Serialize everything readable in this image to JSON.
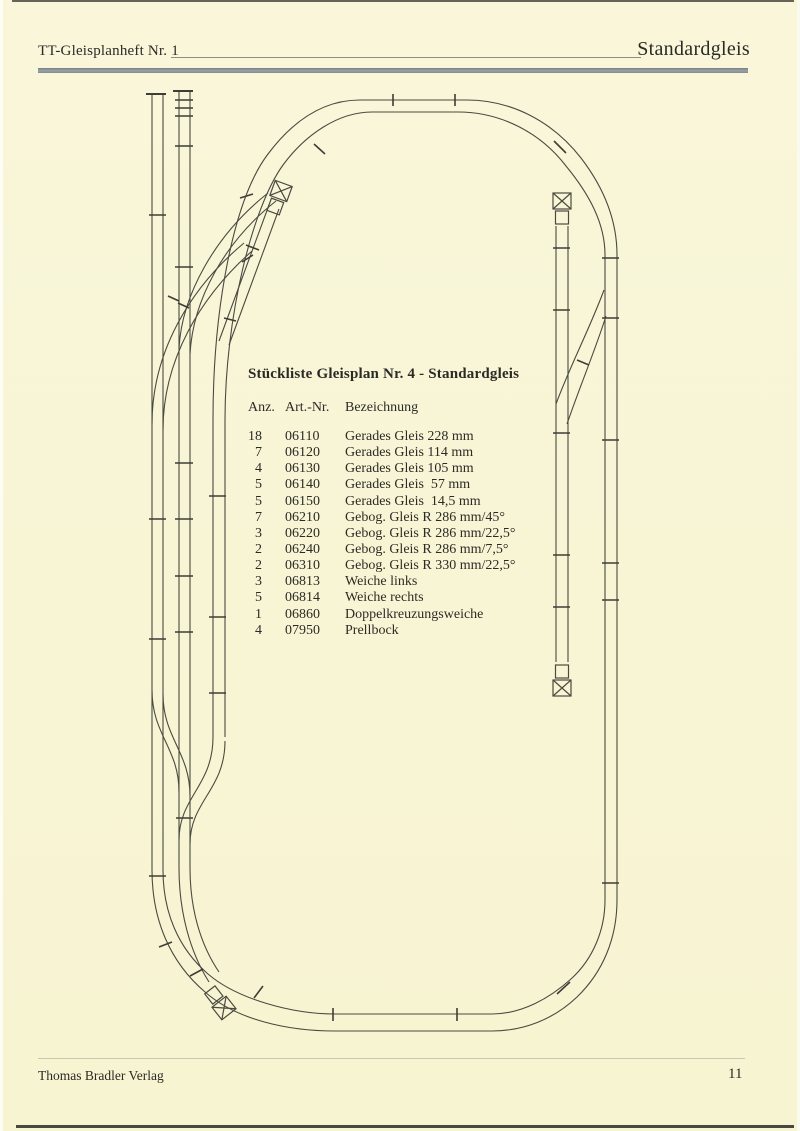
{
  "header": {
    "left_title": "TT-Gleisplanheft Nr. 1",
    "right_title": "Standardgleis"
  },
  "parts_list": {
    "title": "Stückliste Gleisplan Nr. 4 - Standardgleis",
    "columns": {
      "anz": "Anz.",
      "art": "Art.-Nr.",
      "bez": "Bezeichnung"
    },
    "rows": [
      {
        "anz": "18",
        "art": "06110",
        "bez": "Gerades Gleis 228 mm"
      },
      {
        "anz": "7",
        "art": "06120",
        "bez": "Gerades Gleis 114 mm"
      },
      {
        "anz": "4",
        "art": "06130",
        "bez": "Gerades Gleis 105 mm"
      },
      {
        "anz": "5",
        "art": "06140",
        "bez": "Gerades Gleis  57 mm"
      },
      {
        "anz": "5",
        "art": "06150",
        "bez": "Gerades Gleis  14,5 mm"
      },
      {
        "anz": "7",
        "art": "06210",
        "bez": "Gebog. Gleis R 286 mm/45°"
      },
      {
        "anz": "3",
        "art": "06220",
        "bez": "Gebog. Gleis R 286 mm/22,5°"
      },
      {
        "anz": "2",
        "art": "06240",
        "bez": "Gebog. Gleis R 286 mm/7,5°"
      },
      {
        "anz": "2",
        "art": "06310",
        "bez": "Gebog. Gleis R 330 mm/22,5°"
      },
      {
        "anz": "3",
        "art": "06813",
        "bez": "Weiche links"
      },
      {
        "anz": "5",
        "art": "06814",
        "bez": "Weiche rechts"
      },
      {
        "anz": "1",
        "art": "06860",
        "bez": "Doppelkreuzungsweiche"
      },
      {
        "anz": "4",
        "art": "07950",
        "bez": "Prellbock"
      }
    ]
  },
  "footer": {
    "publisher": "Thomas Bradler Verlag",
    "page_number": "11"
  },
  "colors": {
    "paper": "#f8f5d5",
    "rail_line": "#4a4a40",
    "header_bar": "#8a9094"
  },
  "diagram": {
    "type": "track-plan",
    "buffer_stop_symbol": "crossed-box",
    "buffer_stop_count": 4
  }
}
